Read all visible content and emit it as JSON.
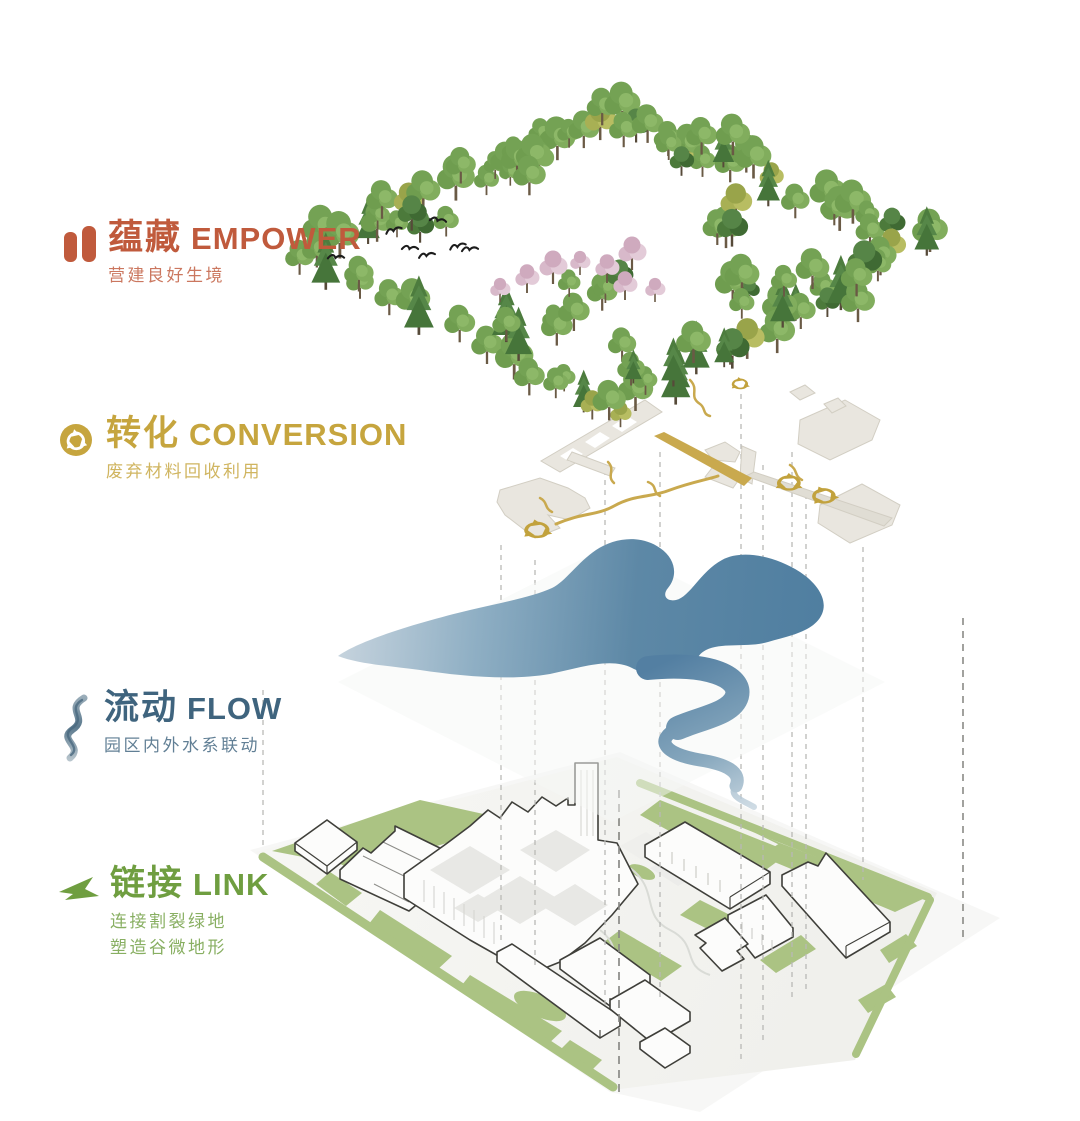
{
  "diagram_title": "exploded site strategy diagram",
  "layers": [
    {
      "key": "empower",
      "title_zh": "蕴藏",
      "title_en": "EMPOWER",
      "subtitle": "营建良好生境",
      "color": "#c05a3c",
      "icon": "seeds-icon"
    },
    {
      "key": "conversion",
      "title_zh": "转化",
      "title_en": "CONVERSION",
      "subtitle": "废弃材料回收利用",
      "color": "#c6a53e",
      "icon": "recycle-icon"
    },
    {
      "key": "flow",
      "title_zh": "流动",
      "title_en": "FLOW",
      "subtitle": "园区内外水系联动",
      "color": "#3f647e",
      "icon": "stream-icon"
    },
    {
      "key": "link",
      "title_zh": "链接",
      "title_en": "LINK",
      "subtitle": "连接割裂绿地",
      "subtitle2": "塑造谷微地形",
      "color": "#6f9e40",
      "icon": "arrow-icon"
    }
  ],
  "colors": {
    "gold": "#c2a23d",
    "gold_path": "#c9a94e",
    "fragment_fill": "#e9e6df",
    "fragment_edge": "#d2cec3",
    "water_deep": "#4f7ea0",
    "water_mid": "#5d88a6",
    "water_light": "#c3d2dd",
    "site_green": "#abc383",
    "site_green_light": "#b7cc92",
    "building_fill": "#fcfcfb",
    "building_line": "#3f3f3a",
    "connector_line": "#b9b9b6",
    "connector_line_dark": "#8a8a86",
    "tree_green": "#74a254",
    "tree_dark": "#3f6a33",
    "blossom_pink": "#d8b9ca",
    "bird_black": "#1c1c1c"
  }
}
